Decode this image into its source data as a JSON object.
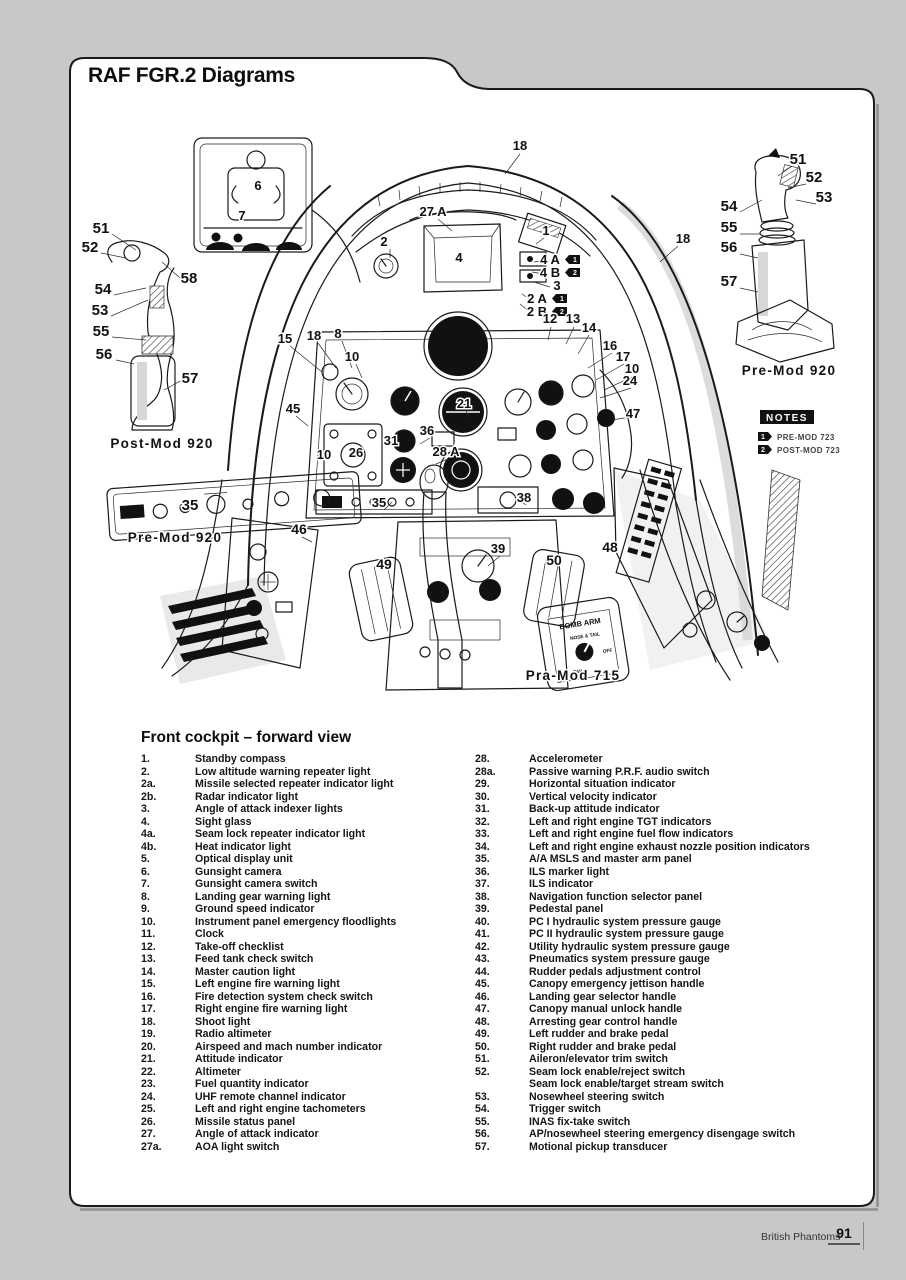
{
  "page": {
    "title": "RAF FGR.2 Diagrams",
    "footer": {
      "book_title": "British Phantoms",
      "page_number": "91"
    }
  },
  "legend": {
    "heading": "Front cockpit – forward view",
    "columns": [
      {
        "items": [
          {
            "num": "1.",
            "label": "Standby compass"
          },
          {
            "num": "2.",
            "label": "Low altitude warning repeater light"
          },
          {
            "num": "2a.",
            "label": "Missile selected repeater indicator light"
          },
          {
            "num": "2b.",
            "label": "Radar indicator light"
          },
          {
            "num": "3.",
            "label": "Angle of attack indexer lights"
          },
          {
            "num": "4.",
            "label": "Sight glass"
          },
          {
            "num": "4a.",
            "label": "Seam lock repeater indicator light"
          },
          {
            "num": "4b.",
            "label": "Heat indicator light"
          },
          {
            "num": "5.",
            "label": "Optical display unit"
          },
          {
            "num": "6.",
            "label": "Gunsight camera"
          },
          {
            "num": "7.",
            "label": "Gunsight camera switch"
          },
          {
            "num": "8.",
            "label": "Landing gear warning light"
          },
          {
            "num": "9.",
            "label": "Ground speed indicator"
          },
          {
            "num": "10.",
            "label": "Instrument panel emergency floodlights"
          },
          {
            "num": "11.",
            "label": "Clock"
          },
          {
            "num": "12.",
            "label": "Take-off checklist"
          },
          {
            "num": "13.",
            "label": "Feed tank check switch"
          },
          {
            "num": "14.",
            "label": "Master caution light"
          },
          {
            "num": "15.",
            "label": "Left engine fire warning light"
          },
          {
            "num": "16.",
            "label": "Fire detection system check switch"
          },
          {
            "num": "17.",
            "label": "Right engine fire warning light"
          },
          {
            "num": "18.",
            "label": "Shoot light"
          },
          {
            "num": "19.",
            "label": "Radio altimeter"
          },
          {
            "num": "20.",
            "label": "Airspeed and mach number indicator"
          },
          {
            "num": "21.",
            "label": "Attitude indicator"
          },
          {
            "num": "22.",
            "label": "Altimeter"
          },
          {
            "num": "23.",
            "label": "Fuel quantity indicator"
          },
          {
            "num": "24.",
            "label": "UHF remote channel indicator"
          },
          {
            "num": "25.",
            "label": "Left and right engine tachometers"
          },
          {
            "num": "26.",
            "label": "Missile status panel"
          },
          {
            "num": "27.",
            "label": "Angle of attack indicator"
          },
          {
            "num": "27a.",
            "label": "AOA light switch"
          }
        ]
      },
      {
        "items": [
          {
            "num": "28.",
            "label": "Accelerometer"
          },
          {
            "num": "28a.",
            "label": "Passive warning P.R.F. audio switch"
          },
          {
            "num": "29.",
            "label": "Horizontal situation indicator"
          },
          {
            "num": "30.",
            "label": "Vertical velocity indicator"
          },
          {
            "num": "31.",
            "label": "Back-up attitude indicator"
          },
          {
            "num": "32.",
            "label": "Left and right engine TGT indicators"
          },
          {
            "num": "33.",
            "label": "Left and right engine fuel flow indicators"
          },
          {
            "num": "34.",
            "label": "Left and right engine exhaust nozzle position indicators"
          },
          {
            "num": "35.",
            "label": "A/A MSLS and master arm panel"
          },
          {
            "num": "36.",
            "label": "ILS marker light"
          },
          {
            "num": "37.",
            "label": "ILS indicator"
          },
          {
            "num": "38.",
            "label": "Navigation function selector panel"
          },
          {
            "num": "39.",
            "label": "Pedestal panel"
          },
          {
            "num": "40.",
            "label": "PC I hydraulic system pressure gauge"
          },
          {
            "num": "41.",
            "label": "PC II hydraulic system pressure gauge"
          },
          {
            "num": "42.",
            "label": "Utility hydraulic system pressure gauge"
          },
          {
            "num": "43.",
            "label": "Pneumatics system pressure gauge"
          },
          {
            "num": "44.",
            "label": "Rudder pedals adjustment control"
          },
          {
            "num": "45.",
            "label": "Canopy emergency jettison handle"
          },
          {
            "num": "46.",
            "label": "Landing gear selector handle"
          },
          {
            "num": "47.",
            "label": "Canopy manual unlock handle"
          },
          {
            "num": "48.",
            "label": "Arresting gear control handle"
          },
          {
            "num": "49.",
            "label": "Left rudder and brake pedal"
          },
          {
            "num": "50.",
            "label": "Right rudder and brake pedal"
          },
          {
            "num": "51.",
            "label": "Aileron/elevator trim switch"
          },
          {
            "num": "52.",
            "label": "Seam lock enable/reject switch"
          },
          {
            "num": "",
            "label": "Seam lock enable/target stream switch"
          },
          {
            "num": "53.",
            "label": "Nosewheel steering switch"
          },
          {
            "num": "54.",
            "label": "Trigger switch"
          },
          {
            "num": "55.",
            "label": "INAS fix-take switch"
          },
          {
            "num": "56.",
            "label": "AP/nosewheel steering emergency disengage switch"
          },
          {
            "num": "57.",
            "label": "Motional pickup transducer"
          }
        ]
      }
    ]
  },
  "diagram": {
    "caption": "Front cockpit – forward view",
    "labels": [
      {
        "text": "Post-Mod 920",
        "x": 162,
        "y": 448
      },
      {
        "text": "Pre-Mod 920",
        "x": 789,
        "y": 375
      },
      {
        "text": "Pre-Mod 920",
        "x": 175,
        "y": 542
      },
      {
        "text": "Pra-Mod 715",
        "x": 573,
        "y": 680
      }
    ],
    "notes": {
      "title": "NOTES",
      "items": [
        {
          "flag": "1",
          "text": "PRE-MOD 723"
        },
        {
          "flag": "2",
          "text": "POST-MOD 723"
        }
      ]
    },
    "bomb_arm": {
      "title": "BOMB ARM",
      "positions": [
        "NOSE & TAIL",
        "OFF",
        "TAIL"
      ]
    },
    "callouts": [
      {
        "t": "18",
        "x": 520,
        "y": 150
      },
      {
        "t": "51",
        "x": 101,
        "y": 233,
        "s": 15
      },
      {
        "t": "52",
        "x": 90,
        "y": 252,
        "s": 15
      },
      {
        "t": "58",
        "x": 189,
        "y": 283,
        "s": 15
      },
      {
        "t": "54",
        "x": 103,
        "y": 294,
        "s": 15
      },
      {
        "t": "53",
        "x": 100,
        "y": 315,
        "s": 15
      },
      {
        "t": "55",
        "x": 101,
        "y": 336,
        "s": 15
      },
      {
        "t": "56",
        "x": 104,
        "y": 359,
        "s": 15
      },
      {
        "t": "57",
        "x": 190,
        "y": 383,
        "s": 15
      },
      {
        "t": "51",
        "x": 798,
        "y": 164,
        "s": 15
      },
      {
        "t": "52",
        "x": 814,
        "y": 182,
        "s": 15
      },
      {
        "t": "53",
        "x": 824,
        "y": 202,
        "s": 15
      },
      {
        "t": "54",
        "x": 729,
        "y": 211,
        "s": 15
      },
      {
        "t": "55",
        "x": 729,
        "y": 232,
        "s": 15
      },
      {
        "t": "56",
        "x": 729,
        "y": 252,
        "s": 15
      },
      {
        "t": "57",
        "x": 729,
        "y": 286,
        "s": 15
      },
      {
        "t": "6",
        "x": 258,
        "y": 190
      },
      {
        "t": "7",
        "x": 242,
        "y": 220
      },
      {
        "t": "27 A",
        "x": 433,
        "y": 216
      },
      {
        "t": "1",
        "x": 546,
        "y": 235
      },
      {
        "t": "2",
        "x": 384,
        "y": 246
      },
      {
        "t": "4",
        "x": 459,
        "y": 262
      },
      {
        "t": "4 A",
        "x": 550,
        "y": 264,
        "flag": "1"
      },
      {
        "t": "4 B",
        "x": 550,
        "y": 277,
        "flag": "2"
      },
      {
        "t": "3",
        "x": 557,
        "y": 290
      },
      {
        "t": "2 A",
        "x": 537,
        "y": 303,
        "flag": "1"
      },
      {
        "t": "2 B",
        "x": 537,
        "y": 316,
        "flag": "2"
      },
      {
        "t": "18",
        "x": 683,
        "y": 243
      },
      {
        "t": "12",
        "x": 550,
        "y": 323
      },
      {
        "t": "13",
        "x": 573,
        "y": 323
      },
      {
        "t": "14",
        "x": 589,
        "y": 332
      },
      {
        "t": "15",
        "x": 285,
        "y": 343
      },
      {
        "t": "18",
        "x": 314,
        "y": 340
      },
      {
        "t": "8",
        "x": 338,
        "y": 338
      },
      {
        "t": "10",
        "x": 352,
        "y": 361
      },
      {
        "t": "16",
        "x": 610,
        "y": 350
      },
      {
        "t": "17",
        "x": 623,
        "y": 361
      },
      {
        "t": "10",
        "x": 632,
        "y": 373
      },
      {
        "t": "24",
        "x": 630,
        "y": 385
      },
      {
        "t": "47",
        "x": 633,
        "y": 418
      },
      {
        "t": "45",
        "x": 293,
        "y": 413
      },
      {
        "t": "10",
        "x": 324,
        "y": 459
      },
      {
        "t": "26",
        "x": 356,
        "y": 457
      },
      {
        "t": "31",
        "x": 391,
        "y": 445
      },
      {
        "t": "36",
        "x": 427,
        "y": 435
      },
      {
        "t": "28 A",
        "x": 446,
        "y": 456
      },
      {
        "t": "21",
        "x": 464,
        "y": 408
      },
      {
        "t": "35",
        "x": 190,
        "y": 510,
        "s": 15
      },
      {
        "t": "35",
        "x": 379,
        "y": 507
      },
      {
        "t": "46",
        "x": 299,
        "y": 534,
        "s": 14
      },
      {
        "t": "38",
        "x": 524,
        "y": 502
      },
      {
        "t": "39",
        "x": 498,
        "y": 553
      },
      {
        "t": "49",
        "x": 384,
        "y": 569,
        "s": 14
      },
      {
        "t": "50",
        "x": 554,
        "y": 565,
        "s": 14
      },
      {
        "t": "48",
        "x": 610,
        "y": 552,
        "s": 14
      }
    ]
  }
}
